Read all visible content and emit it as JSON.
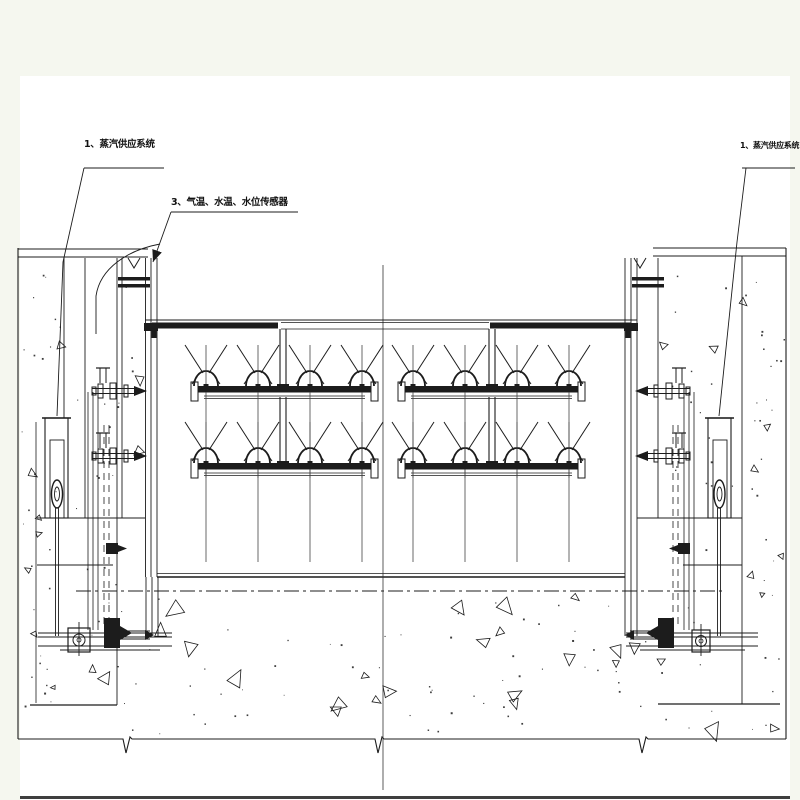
{
  "page": {
    "background": "#f5f7ef",
    "sheet_color": "#ffffff",
    "ink_color": "#1c1c1c",
    "centerline_color": "#333333"
  },
  "drawing": {
    "type": "engineering-section-drawing",
    "subject": "gate-section-with-steam-piping-and-sensors",
    "annotations": [
      {
        "id": "steam-supply-left",
        "text": "1、蒸汽供应系统"
      },
      {
        "id": "air-water-temp-level-sensors",
        "text": "3、气温、水温、水位传感器"
      },
      {
        "id": "steam-supply-right",
        "text": "1、蒸汽供应系统"
      }
    ]
  }
}
